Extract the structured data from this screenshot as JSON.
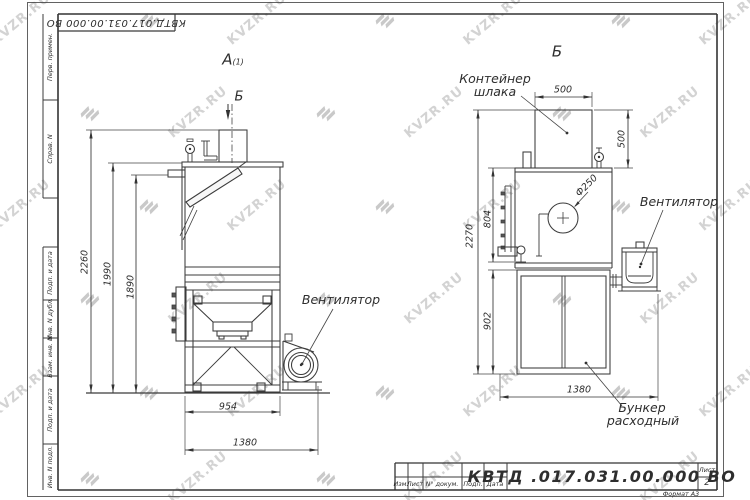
{
  "watermark": {
    "text": "KVZR.RU"
  },
  "frame": {
    "doc_number_top": "КВТД.017.031.00.000 ВО",
    "margin_labels": [
      "Перв. примен.",
      "Справ. N",
      "Подп. и дата",
      "Инв. N дубл.",
      "Взам. инв. N",
      "Подп. и дата",
      "Инв. N подл."
    ]
  },
  "title_block": {
    "columns": [
      "Изм.",
      "Лист",
      "N° докум.",
      "Подп.",
      "Дата"
    ],
    "designation": "КВТД .017.031.00.000  ВО",
    "sheet_label": "Лист",
    "sheet_number": "2",
    "format_label": "Формат А3"
  },
  "views": {
    "left": {
      "label": "А",
      "label_sub": "(1)",
      "section_arrow_label": "Б",
      "fan_label": "Вентилятор",
      "dims": {
        "overall_height": "2260",
        "body_height": "1990",
        "flange_height": "1890",
        "body_width": "954",
        "overall_width": "1380"
      }
    },
    "right": {
      "label": "Б",
      "container_label": [
        "Контейнер",
        "шлака"
      ],
      "fan_label": "Вентилятор",
      "hopper_label": [
        "Бункер",
        "расходный"
      ],
      "dims": {
        "container_width": "500",
        "container_height": "500",
        "overall_height": "2270",
        "body_side_height": "804",
        "hopper_height": "902",
        "inlet_diameter": "Ф250",
        "overall_width": "1380"
      }
    }
  }
}
